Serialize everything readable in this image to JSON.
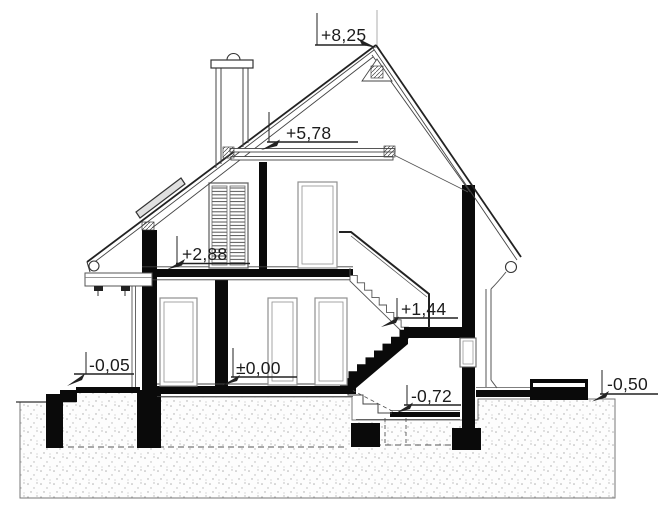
{
  "drawing": {
    "title": "house-cross-section",
    "levels": [
      {
        "id": "ridge",
        "label": "+8,25"
      },
      {
        "id": "collar-beam",
        "label": "+5,78"
      },
      {
        "id": "attic-floor",
        "label": "+2,88"
      },
      {
        "id": "stair-landing",
        "label": "+1,44"
      },
      {
        "id": "ground-floor",
        "label": "±0,00"
      },
      {
        "id": "entrance-platform",
        "label": "-0,05"
      },
      {
        "id": "sunken-floor",
        "label": "-0,72"
      },
      {
        "id": "terrace-ground",
        "label": "-0,50"
      }
    ],
    "colors": {
      "background": "#ffffff",
      "line": "#3a3a3a",
      "cut_fill": "#0a0a0a",
      "ground_dots": "#aaaaaa",
      "text": "#1c1c1c"
    }
  }
}
